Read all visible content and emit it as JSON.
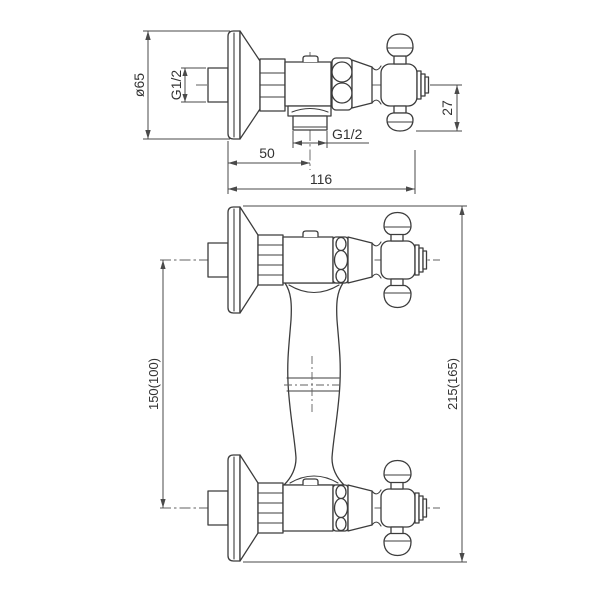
{
  "side_view": {
    "dims": {
      "flange_diameter": "ø65",
      "wall_thread": "G1/2",
      "outlet_thread": "G1/2",
      "outlet_offset": "50",
      "total_depth": "116",
      "handle_height": "27"
    }
  },
  "front_view": {
    "dims": {
      "valve_center_distance": "150(100)",
      "overall_height": "215(165)"
    }
  },
  "colors": {
    "object_line": "#3c3c3c",
    "dimension_line": "#4a4a4a",
    "text": "#333333",
    "background": "#ffffff"
  }
}
